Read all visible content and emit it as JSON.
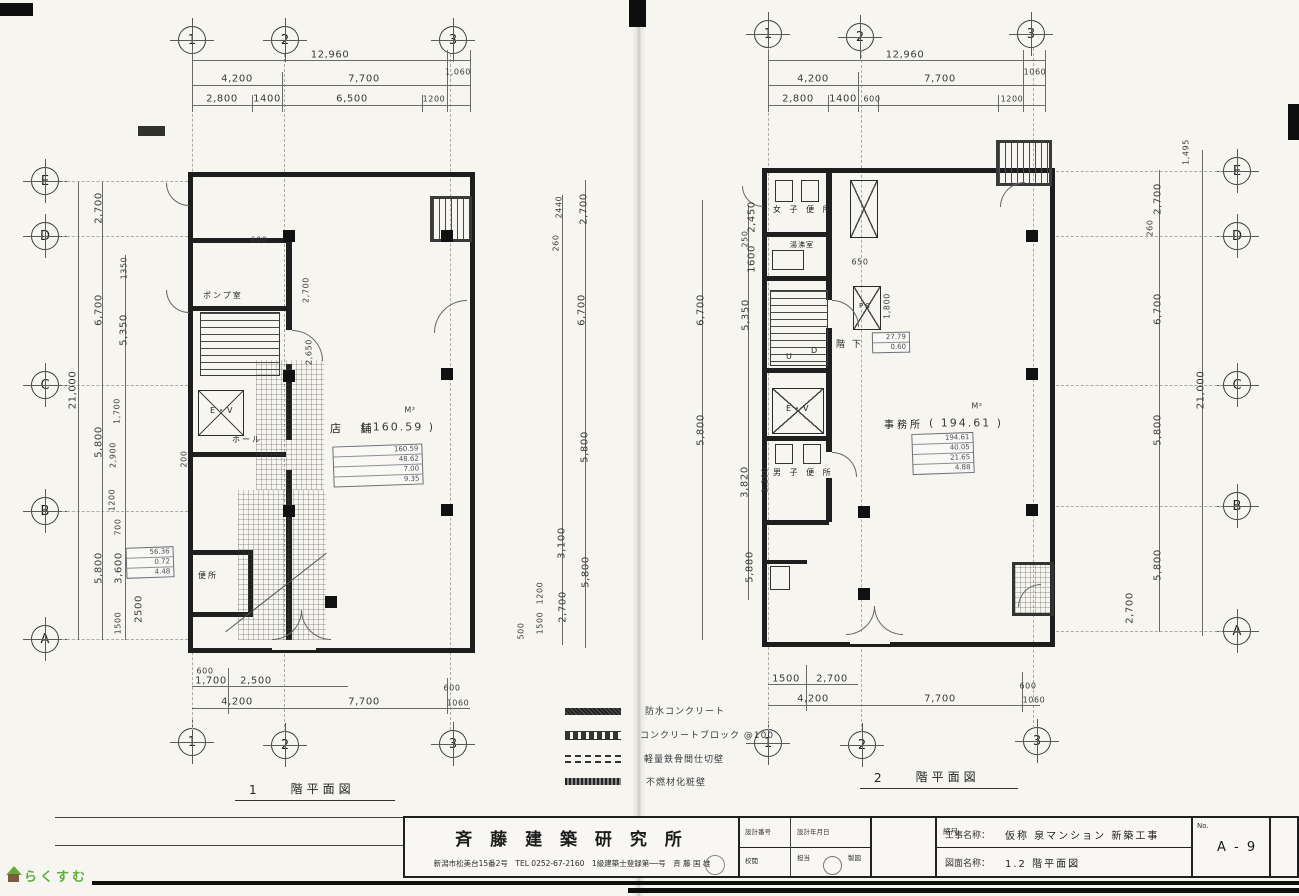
{
  "watermark": {
    "text": "らくすむ"
  },
  "grid": {
    "cols": [
      "1",
      "2",
      "3"
    ],
    "rows": [
      "E",
      "D",
      "C",
      "B",
      "A"
    ]
  },
  "plan1": {
    "caption_no": "1",
    "caption_text": "階平面図",
    "labels": {
      "pump": "ポンプ室",
      "ev": "E・V",
      "hall": "ホール",
      "toilet": "便所",
      "shop": "店 舗",
      "area": "( 160.59 )",
      "unit": "M²"
    },
    "calc": [
      "160.59",
      "48.62",
      "7.00",
      "9.35"
    ],
    "side_calc": [
      "56.36",
      "0.72",
      "4.48"
    ],
    "dims": {
      "top_total": "12,960",
      "top_a": "4,200",
      "top_b": "7,700",
      "top_c": "1,060",
      "top_d": "2,800",
      "top_e": "1400",
      "top_f": "6,500",
      "top_g": "1200",
      "left_total": "21,000",
      "left_a": "2,700",
      "left_b": "6,700",
      "left_c": "5,800",
      "left_d": "5,800",
      "sub_a": "1350",
      "sub_b": "5,350",
      "sub_c": "1,700",
      "sub_d": "2,900",
      "sub_e": "1200",
      "sub_f": "700",
      "sub_g": "3,600",
      "sub_h": "2500",
      "sub_i": "1500",
      "wall": "200",
      "in_a": "600",
      "in_b": "2,700",
      "in_c": "2,650",
      "right_a": "2440",
      "right_b": "260",
      "right_c": "2,700",
      "right_d": "6,700",
      "right_e": "5,800",
      "right_f": "3,100",
      "right_g": "5,800",
      "right_h": "1200",
      "right_i": "2,700",
      "right_j": "1500",
      "right_k": "500",
      "bot_a": "600",
      "bot_b": "1,700",
      "bot_c": "2,500",
      "bot_d": "600",
      "bot_e": "4,200",
      "bot_f": "7,700",
      "bot_g": "1060"
    }
  },
  "plan2": {
    "caption_no": "2",
    "caption_text": "階平面図",
    "labels": {
      "wtoilet": "女 子 便 所",
      "kitchen": "湯沸室",
      "u": "U",
      "d": "D",
      "below": "階 下",
      "ps": "PS",
      "ev": "E・V",
      "mtoilet": "男 子 便 所",
      "office": "事務所",
      "area": "( 194.61 )",
      "unit": "M²"
    },
    "note": [
      "27.79",
      "0.60"
    ],
    "calc": [
      "194.61",
      "40.05",
      "21.65",
      "4.88"
    ],
    "dims": {
      "top_total": "12,960",
      "top_a": "4,200",
      "top_b": "7,700",
      "top_c": "1060",
      "top_d": "2,800",
      "top_e": "1400",
      "top_f": "600",
      "top_g": "1200",
      "right_total": "21,000",
      "right_a": "2,700",
      "right_b": "260",
      "right_c": "6,700",
      "right_d": "5,800",
      "right_e": "5,800",
      "right_f": "2,700",
      "stair": "1,495",
      "left_a": "2,450",
      "left_b": "250",
      "left_c": "1600",
      "left_d": "5,350",
      "left_e": "6,700",
      "left_f": "5,800",
      "left_g": "3,820",
      "left_h": "1,280",
      "left_i": "5,880",
      "in_a": "650",
      "in_b": "1,800",
      "bot_a": "1500",
      "bot_b": "2,700",
      "bot_c": "600",
      "bot_d": "4,200",
      "bot_e": "7,700",
      "bot_f": "1060"
    }
  },
  "legend": {
    "items": [
      "防水コンクリート",
      "コンクリートブロック @100",
      "軽量鉄骨間仕切壁",
      "不燃材化粧壁"
    ]
  },
  "titleblock": {
    "firm": "斉 藤 建 築 研 究 所",
    "address": "新潟市松美台15番2号　TEL 0252-67-2160　1級建築士登録第──号　斉 藤 国 雄",
    "design_no": "設計番号",
    "design_date": "設計年月日",
    "review": "校閲",
    "charge": "担当",
    "draft": "製図",
    "scale": "縮尺",
    "project_label": "工事名称：",
    "project": "仮称 泉マンション 新築工事",
    "drawing_label": "図面名称：",
    "drawing": "1.2 階平面図",
    "no_label": "No.",
    "sheet_no": "A - 9"
  }
}
